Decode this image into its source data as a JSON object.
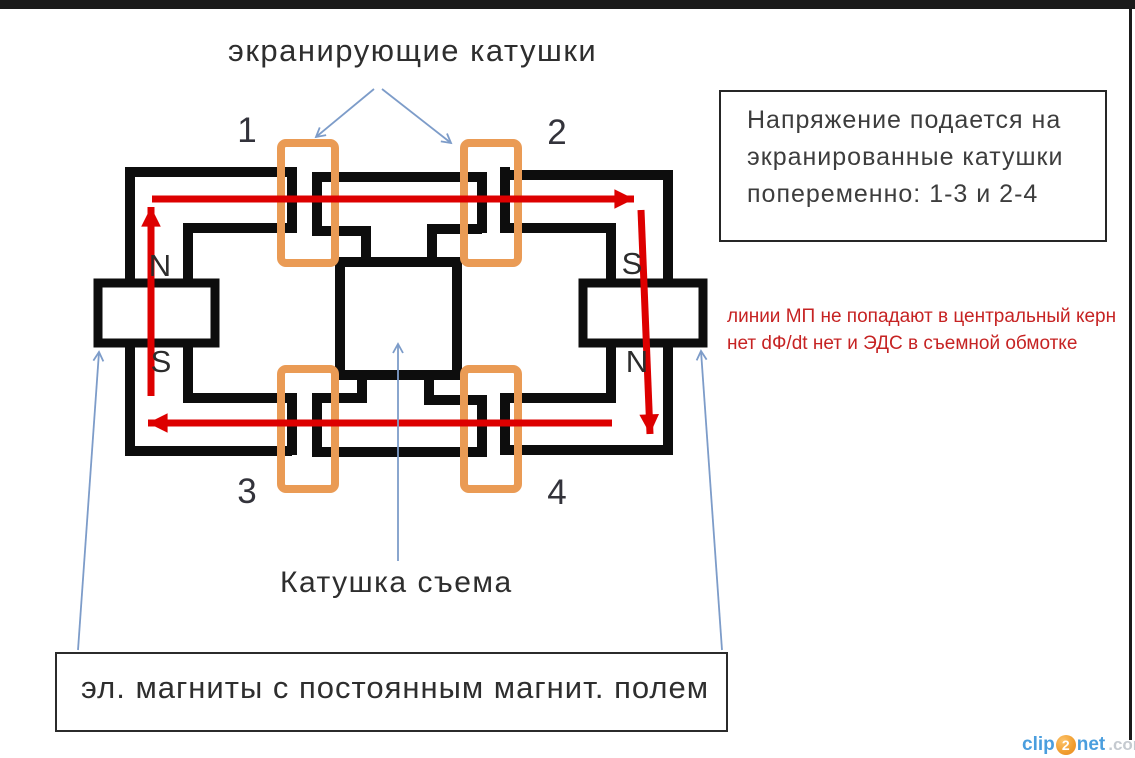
{
  "title": "экранирующие катушки",
  "coil_numbers": [
    "1",
    "2",
    "3",
    "4"
  ],
  "poles": {
    "left_top": "N",
    "left_bottom": "S",
    "right_top": "S",
    "right_bottom": "N"
  },
  "note_box": {
    "lines": [
      "Напряжение подается на",
      "экранированные катушки",
      "попеременно: 1-3 и 2-4"
    ]
  },
  "red_note": {
    "lines": [
      "линии МП не попадают в центральный керн",
      "нет dФ/dt нет и ЭДС в съемной обмотке"
    ]
  },
  "pickup_coil_label": "Катушка съема",
  "magnets_label": "эл. магниты с постоянным магнит. полем",
  "watermark": {
    "clip": "clip",
    "two": "2",
    "net": "net",
    "dotcom": ".com"
  },
  "colors": {
    "core": "#0d0d0d",
    "coil_orange": "#ea9b55",
    "flux_red": "#dd0000",
    "pointer_blue": "#7d9cc9",
    "red_note": "#c62323",
    "text_dark": "#3a3a3a",
    "spellcheck_green": "#3aa83a",
    "watermark_blue": "#4a9ede",
    "watermark_orange": "#f09d2e",
    "watermark_gray": "#c5cad0",
    "frame_dark": "#1b1b1b"
  }
}
